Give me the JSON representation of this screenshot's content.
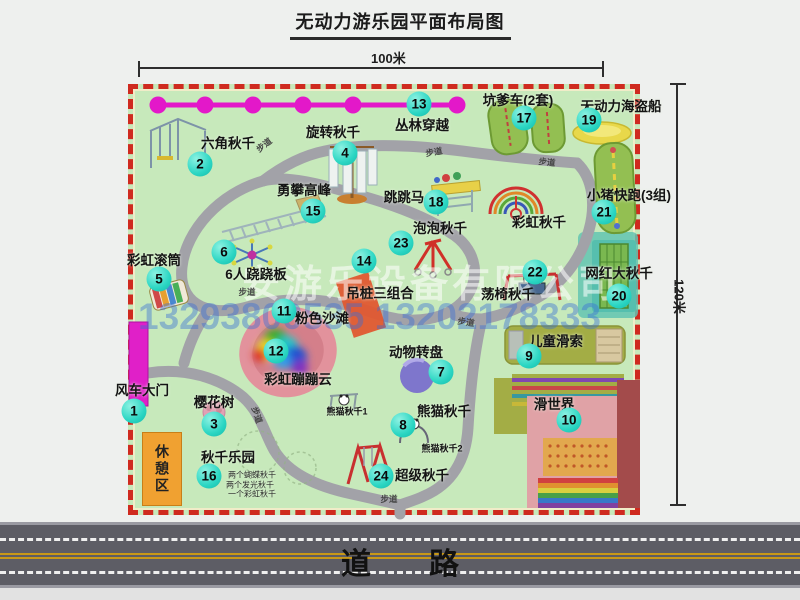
{
  "title": "无动力游乐园平面布局图",
  "dims": {
    "top": "100米",
    "right": "120米"
  },
  "road_label": "道路",
  "rest_area_label": "休憩区",
  "watermark": {
    "company": "安游乐设备有限公司",
    "phone": "13293800535 13202178333"
  },
  "attractions": [
    {
      "n": "1",
      "name": "风车大门",
      "label": [
        142,
        389
      ],
      "badge": [
        134,
        411
      ]
    },
    {
      "n": "2",
      "name": "六角秋千",
      "label": [
        228,
        142
      ],
      "badge": [
        200,
        164
      ]
    },
    {
      "n": "3",
      "name": "樱花树",
      "label": [
        214,
        401
      ],
      "badge": [
        214,
        424
      ]
    },
    {
      "n": "4",
      "name": "旋转秋千",
      "label": [
        333,
        131
      ],
      "badge": [
        345,
        153
      ]
    },
    {
      "n": "5",
      "name": "彩虹滚筒",
      "label": [
        154,
        259
      ],
      "badge": [
        159,
        279
      ]
    },
    {
      "n": "6",
      "name": "6人跷跷板",
      "label": [
        256,
        273
      ],
      "badge": [
        224,
        252
      ]
    },
    {
      "n": "7",
      "name": "动物转盘",
      "label": [
        416,
        351
      ],
      "badge": [
        441,
        372
      ]
    },
    {
      "n": "8",
      "name": "熊猫秋千",
      "label": [
        444,
        410
      ],
      "badge": [
        403,
        425
      ]
    },
    {
      "n": "9",
      "name": "儿童滑索",
      "label": [
        556,
        340
      ],
      "badge": [
        529,
        356
      ]
    },
    {
      "n": "10",
      "name": "滑世界",
      "label": [
        554,
        403
      ],
      "badge": [
        569,
        420
      ]
    },
    {
      "n": "11",
      "name": "粉色沙滩",
      "label": [
        322,
        317
      ],
      "badge": [
        284,
        311
      ]
    },
    {
      "n": "12",
      "name": "彩虹蹦蹦云",
      "label": [
        298,
        378
      ],
      "badge": [
        276,
        351
      ]
    },
    {
      "n": "13",
      "name": "丛林穿越",
      "label": [
        422,
        124
      ],
      "badge": [
        419,
        104
      ]
    },
    {
      "n": "14",
      "name": "吊桩三组合",
      "label": [
        380,
        292
      ],
      "badge": [
        364,
        261
      ]
    },
    {
      "n": "15",
      "name": "勇攀高峰",
      "label": [
        304,
        189
      ],
      "badge": [
        313,
        211
      ]
    },
    {
      "n": "16",
      "name": "秋千乐园",
      "label": [
        228,
        456
      ],
      "badge": [
        209,
        476
      ]
    },
    {
      "n": "17",
      "name": "坑爹车(2套)",
      "label": [
        518,
        99
      ],
      "badge": [
        524,
        118
      ]
    },
    {
      "n": "18",
      "name": "跳跳马",
      "label": [
        404,
        196
      ],
      "badge": [
        436,
        202
      ]
    },
    {
      "n": "19",
      "name": "无动力海盗船",
      "label": [
        621,
        105
      ],
      "badge": [
        589,
        120
      ]
    },
    {
      "n": "20",
      "name": "网红大秋千",
      "label": [
        619,
        272
      ],
      "badge": [
        619,
        296
      ]
    },
    {
      "n": "21",
      "name": "小猪快跑(3组)",
      "label": [
        629,
        194
      ],
      "badge": [
        604,
        212
      ]
    },
    {
      "n": "22",
      "name": "荡椅秋千",
      "label": [
        508,
        293
      ],
      "badge": [
        535,
        272
      ]
    },
    {
      "n": "23",
      "name": "泡泡秋千",
      "label": [
        440,
        227
      ],
      "badge": [
        401,
        243
      ]
    },
    {
      "n": "24",
      "name": "超级秋千",
      "label": [
        422,
        474
      ],
      "badge": [
        381,
        476
      ]
    }
  ],
  "extra_labels": [
    {
      "text": "彩虹秋千",
      "x": 539,
      "y": 221
    },
    {
      "text": "熊猫秋千1",
      "x": 347,
      "y": 411,
      "cls": "small"
    },
    {
      "text": "熊猫秋千2",
      "x": 442,
      "y": 448,
      "cls": "small"
    },
    {
      "text": "两个蝴蝶秋千",
      "x": 252,
      "y": 475,
      "cls": "tiny"
    },
    {
      "text": "两个发光秋千",
      "x": 250,
      "y": 485,
      "cls": "tiny"
    },
    {
      "text": "一个彩虹秋千",
      "x": 252,
      "y": 494,
      "cls": "tiny"
    }
  ],
  "walkway": {
    "text": "步道",
    "positions": [
      {
        "x": 264,
        "y": 145,
        "r": -38
      },
      {
        "x": 434,
        "y": 152,
        "r": -10
      },
      {
        "x": 547,
        "y": 162,
        "r": 6
      },
      {
        "x": 247,
        "y": 292,
        "r": 0
      },
      {
        "x": 466,
        "y": 322,
        "r": 8
      },
      {
        "x": 257,
        "y": 415,
        "r": 72
      },
      {
        "x": 389,
        "y": 499,
        "r": 0
      }
    ]
  }
}
